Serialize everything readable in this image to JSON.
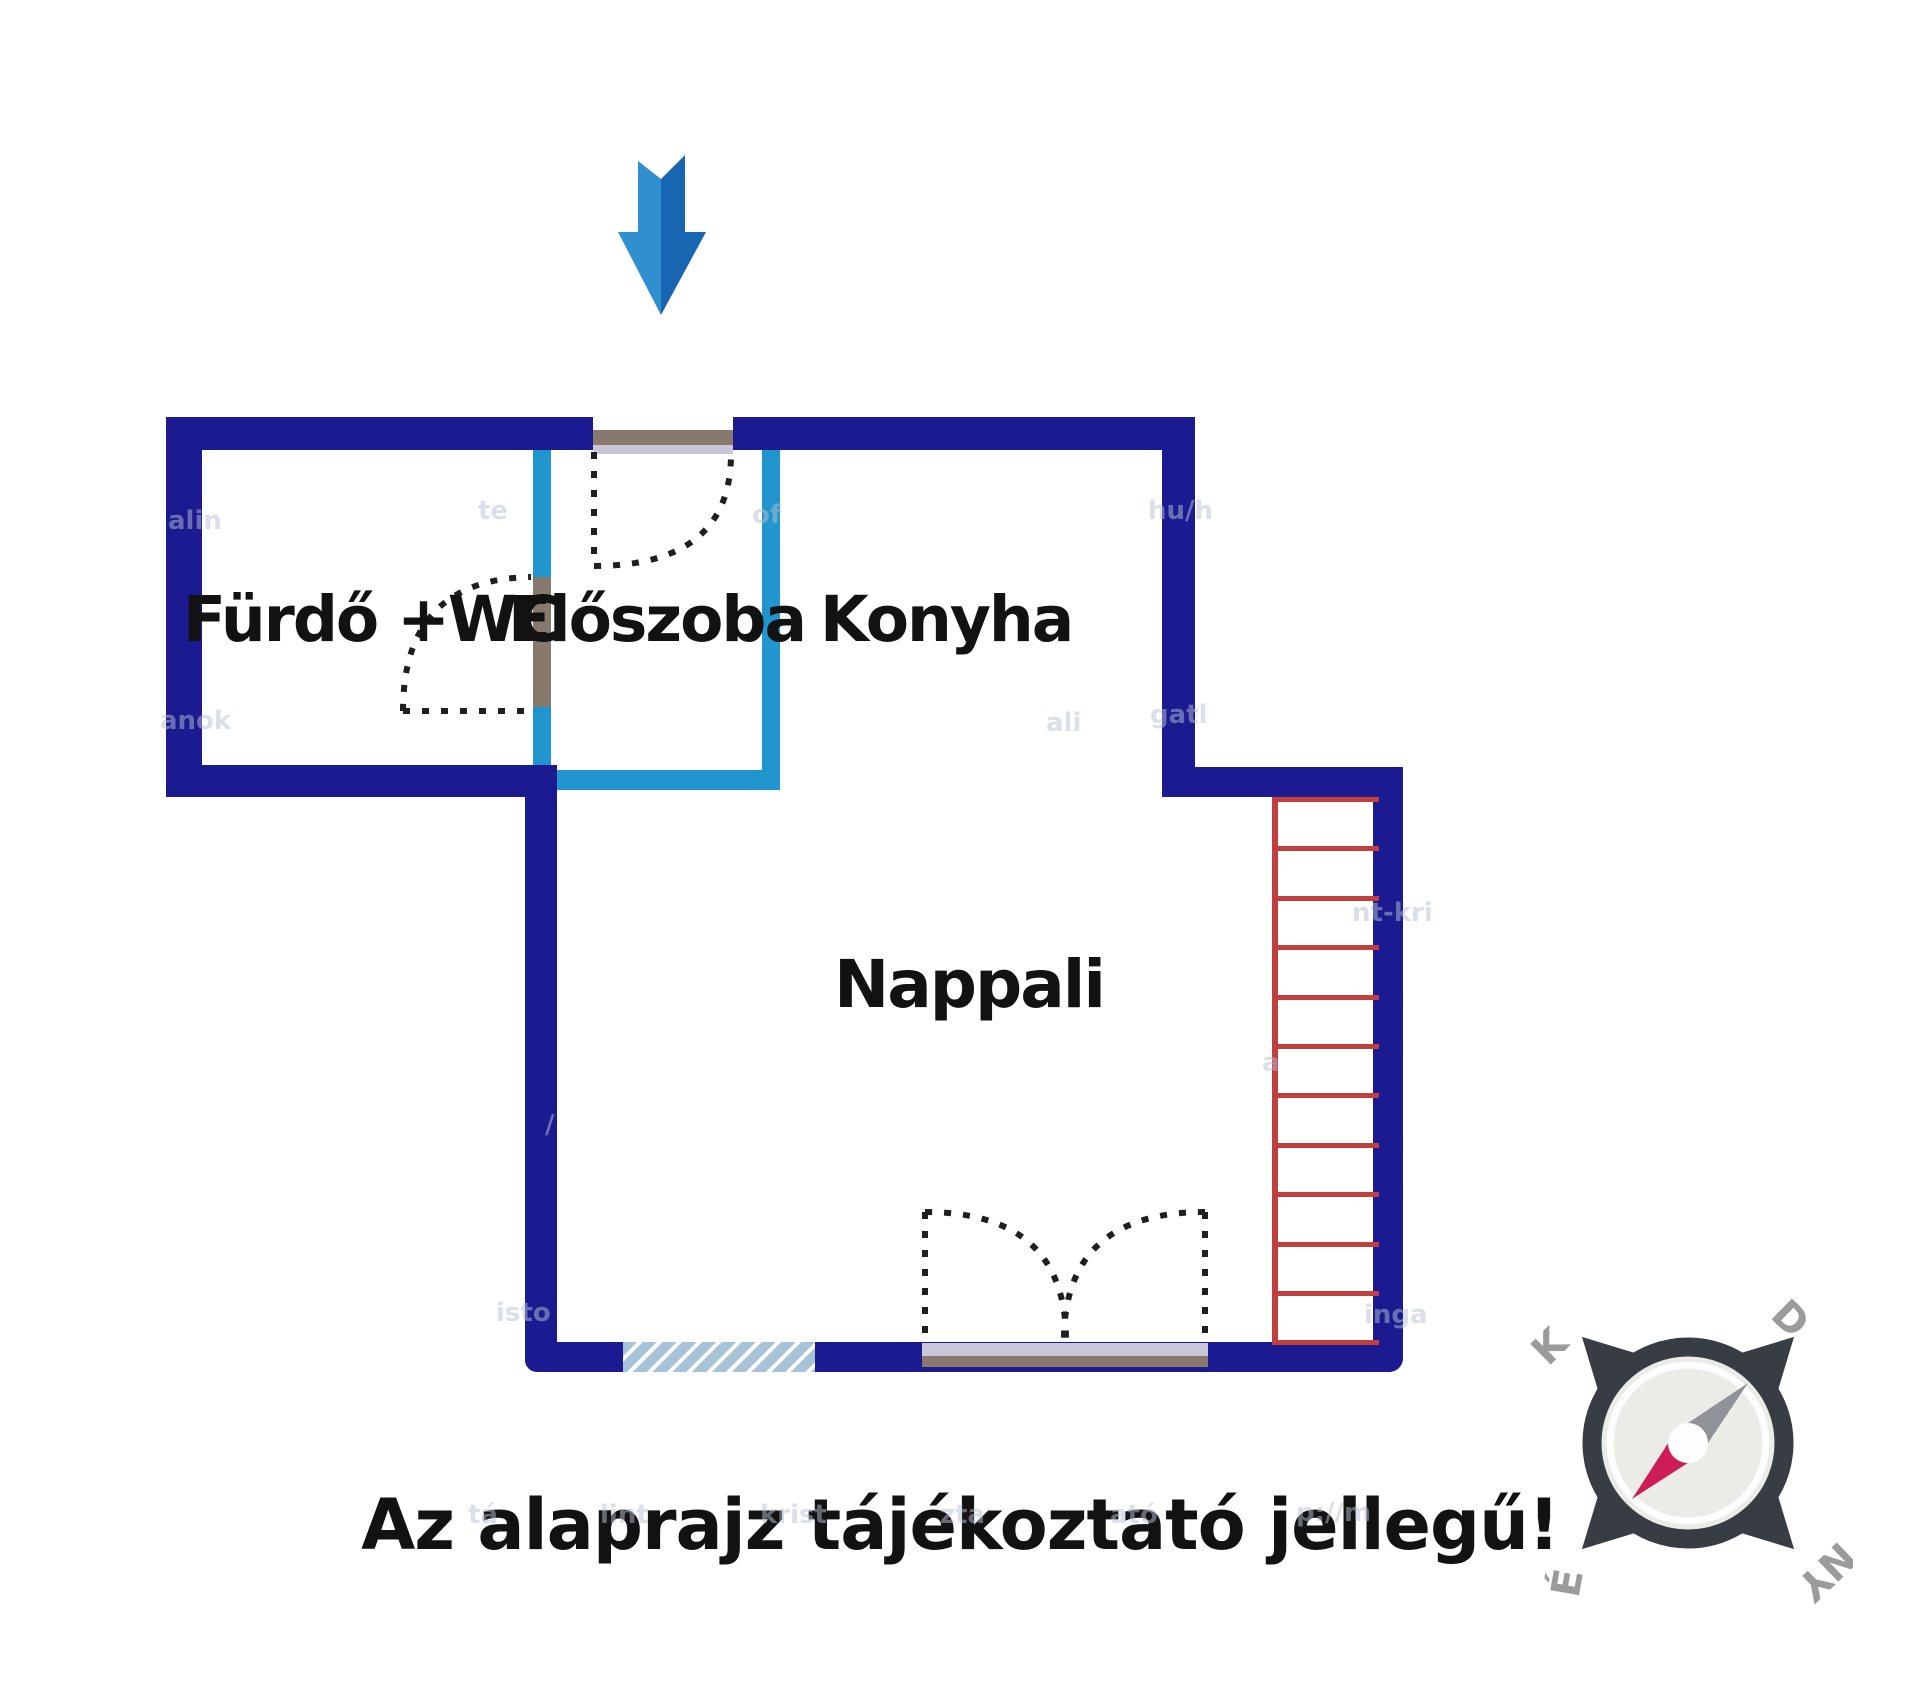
{
  "floor_plan": {
    "rooms": [
      {
        "name": "Fürdő +WC"
      },
      {
        "name": "Előszoba"
      },
      {
        "name": "Konyha"
      },
      {
        "name": "Nappali"
      }
    ],
    "caption": "Az alaprajz tájékoztató jellegű!"
  },
  "compass": {
    "top_left": "K",
    "top_right": "D",
    "bottom_left": "É",
    "bottom_right": "NY"
  },
  "ladder": {
    "rung_count": 12,
    "rung_spacing": 49.4
  },
  "colors": {
    "wall": "#1c1a91",
    "partition": "#2196ce",
    "ladder": "#c04040",
    "door_frame": "#87796e",
    "door_sill": "#c9c6da",
    "window_fill": "#a6c3d7",
    "arrow_light": "#3090cf",
    "arrow_dark": "#1865b2",
    "compass_dark": "#383d43",
    "compass_disc": "#ebebe8",
    "compass_needle_gray": "#8f9296",
    "compass_needle_red": "#ce1d56",
    "compass_letters": "#9b9b9b",
    "label_text": "#121212",
    "watermark": "#b6c0d2"
  },
  "watermarks": [
    {
      "text": "alin",
      "x": 168,
      "y": 506
    },
    {
      "text": "anok",
      "x": 160,
      "y": 706
    },
    {
      "text": "te",
      "x": 478,
      "y": 496
    },
    {
      "text": "of",
      "x": 752,
      "y": 500
    },
    {
      "text": "hu/h",
      "x": 1148,
      "y": 496
    },
    {
      "text": "ali",
      "x": 1046,
      "y": 708
    },
    {
      "text": "gatl",
      "x": 1150,
      "y": 700
    },
    {
      "text": "/",
      "x": 545,
      "y": 1110
    },
    {
      "text": "nt-kri",
      "x": 1352,
      "y": 898
    },
    {
      "text": "isto",
      "x": 496,
      "y": 1298
    },
    {
      "text": "inga",
      "x": 1364,
      "y": 1300
    },
    {
      "text": "a",
      "x": 1262,
      "y": 1048
    },
    {
      "text": "p://m",
      "x": 1296,
      "y": 1498
    },
    {
      "text": "tá",
      "x": 468,
      "y": 1500
    },
    {
      "text": "lint",
      "x": 600,
      "y": 1500
    },
    {
      "text": "krist",
      "x": 760,
      "y": 1500
    },
    {
      "text": "zta",
      "x": 940,
      "y": 1500
    },
    {
      "text": "ató",
      "x": 1110,
      "y": 1500
    }
  ]
}
